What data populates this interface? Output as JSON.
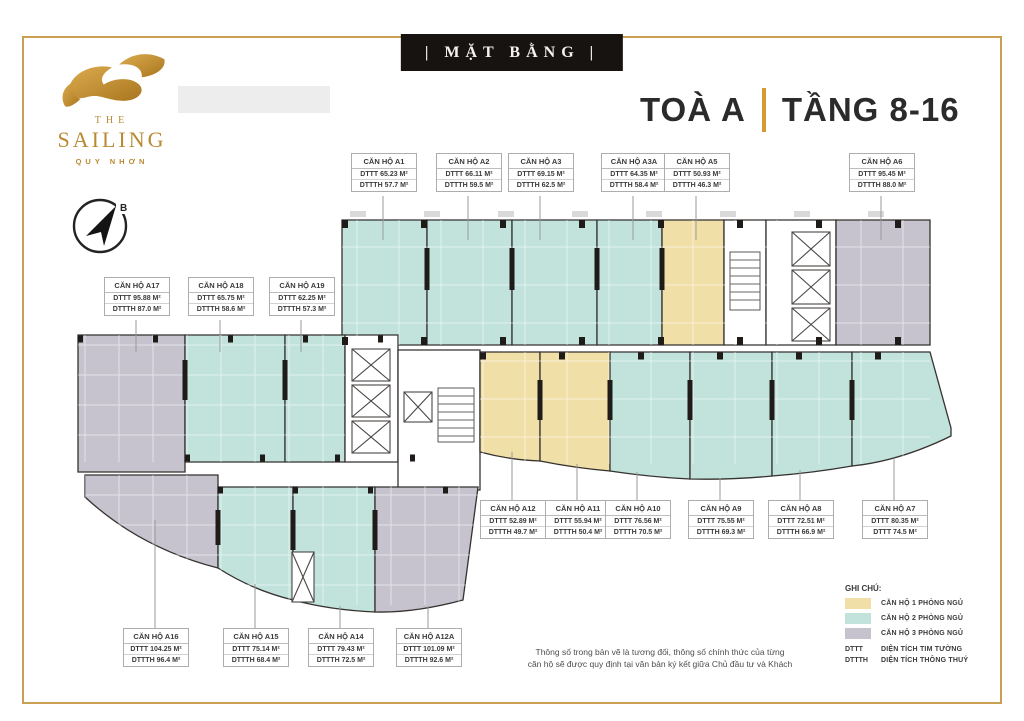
{
  "banner": {
    "text": "| MẶT BẰNG |"
  },
  "logo": {
    "the": "THE",
    "name": "SAILING",
    "city": "QUY NHƠN"
  },
  "title": {
    "building": "TOÀ A",
    "separator": "|",
    "floors": "TẦNG 8-16"
  },
  "compass": {
    "north_label": "B"
  },
  "units": [
    {
      "name": "CĂN HỘ A1",
      "dttt": "DTTT 65.23 M²",
      "dttth": "DTTTH 57.7 M²"
    },
    {
      "name": "CĂN HỘ A2",
      "dttt": "DTTT 66.11 M²",
      "dttth": "DTTTH 59.5 M²"
    },
    {
      "name": "CĂN HỘ A3",
      "dttt": "DTTT 69.15 M²",
      "dttth": "DTTTH 62.5 M²"
    },
    {
      "name": "CĂN HỘ A3A",
      "dttt": "DTTT 64.35 M²",
      "dttth": "DTTTH 58.4 M²"
    },
    {
      "name": "CĂN HỘ A5",
      "dttt": "DTTT 50.93 M²",
      "dttth": "DTTTH 46.3 M²"
    },
    {
      "name": "CĂN HỘ A6",
      "dttt": "DTTT 95.45 M²",
      "dttth": "DTTTH 88.0 M²"
    },
    {
      "name": "CĂN HỘ A17",
      "dttt": "DTTT 95.88 M²",
      "dttth": "DTTTH 87.0 M²"
    },
    {
      "name": "CĂN HỘ A18",
      "dttt": "DTTT 65.75 M²",
      "dttth": "DTTTH 58.6 M²"
    },
    {
      "name": "CĂN HỘ A19",
      "dttt": "DTTT 62.25 M²",
      "dttth": "DTTTH 57.3 M²"
    },
    {
      "name": "CĂN HỘ A12",
      "dttt": "DTTT 52.89 M²",
      "dttth": "DTTTH 49.7 M²"
    },
    {
      "name": "CĂN HỘ A11",
      "dttt": "DTTT 55.94 M²",
      "dttth": "DTTTH 50.4 M²"
    },
    {
      "name": "CĂN HỘ A10",
      "dttt": "DTTT 76.56 M²",
      "dttth": "DTTTH 70.5 M²"
    },
    {
      "name": "CĂN HỘ A9",
      "dttt": "DTTT 75.55 M²",
      "dttth": "DTTTH 69.3 M²"
    },
    {
      "name": "CĂN HỘ A8",
      "dttt": "DTTT 72.51 M²",
      "dttth": "DTTTH 66.9 M²"
    },
    {
      "name": "CĂN HỘ A7",
      "dttt": "DTTT 80.35 M²",
      "dttth": "DTTT 74.5 M²"
    },
    {
      "name": "CĂN HỘ A16",
      "dttt": "DTTT 104.25 M²",
      "dttth": "DTTTH 96.4 M²"
    },
    {
      "name": "CĂN HỘ A15",
      "dttt": "DTTT 75.14 M²",
      "dttth": "DTTTH 68.4 M²"
    },
    {
      "name": "CĂN HỘ A14",
      "dttt": "DTTT 79.43 M²",
      "dttth": "DTTTH 72.5 M²"
    },
    {
      "name": "CĂN HỘ A12A",
      "dttt": "DTTT 101.09 M²",
      "dttth": "DTTTH 92.6 M²"
    }
  ],
  "legend": {
    "title": "GHI CHÚ:",
    "types": [
      {
        "color": "#F1DFA8",
        "label": "CĂN HỘ 1 PHÒNG NGỦ"
      },
      {
        "color": "#C2E2DC",
        "label": "CĂN HỘ 2 PHÒNG NGỦ"
      },
      {
        "color": "#C6C2CE",
        "label": "CĂN HỘ 3 PHÒNG NGỦ"
      }
    ],
    "abbreviations": [
      {
        "abbr": "DTTT",
        "label": "DIỆN TÍCH TIM TƯỜNG"
      },
      {
        "abbr": "DTTTH",
        "label": "DIỆN TÍCH THÔNG THUỶ"
      }
    ]
  },
  "disclaimer": {
    "line1": "Thông số trong bản vẽ là tương đối, thông số chính thức của từng",
    "line2": "căn hộ sẽ được quy định tại văn bản ký kết giữa Chủ đầu tư và Khách"
  },
  "colors": {
    "accent_gold": "#C9A053",
    "title_separator": "#D79A33",
    "banner_bg": "#161310",
    "one_bedroom": "#F1DFA8",
    "two_bedroom": "#C2E2DC",
    "three_bedroom": "#C6C2CE",
    "walls": "#35322F"
  }
}
